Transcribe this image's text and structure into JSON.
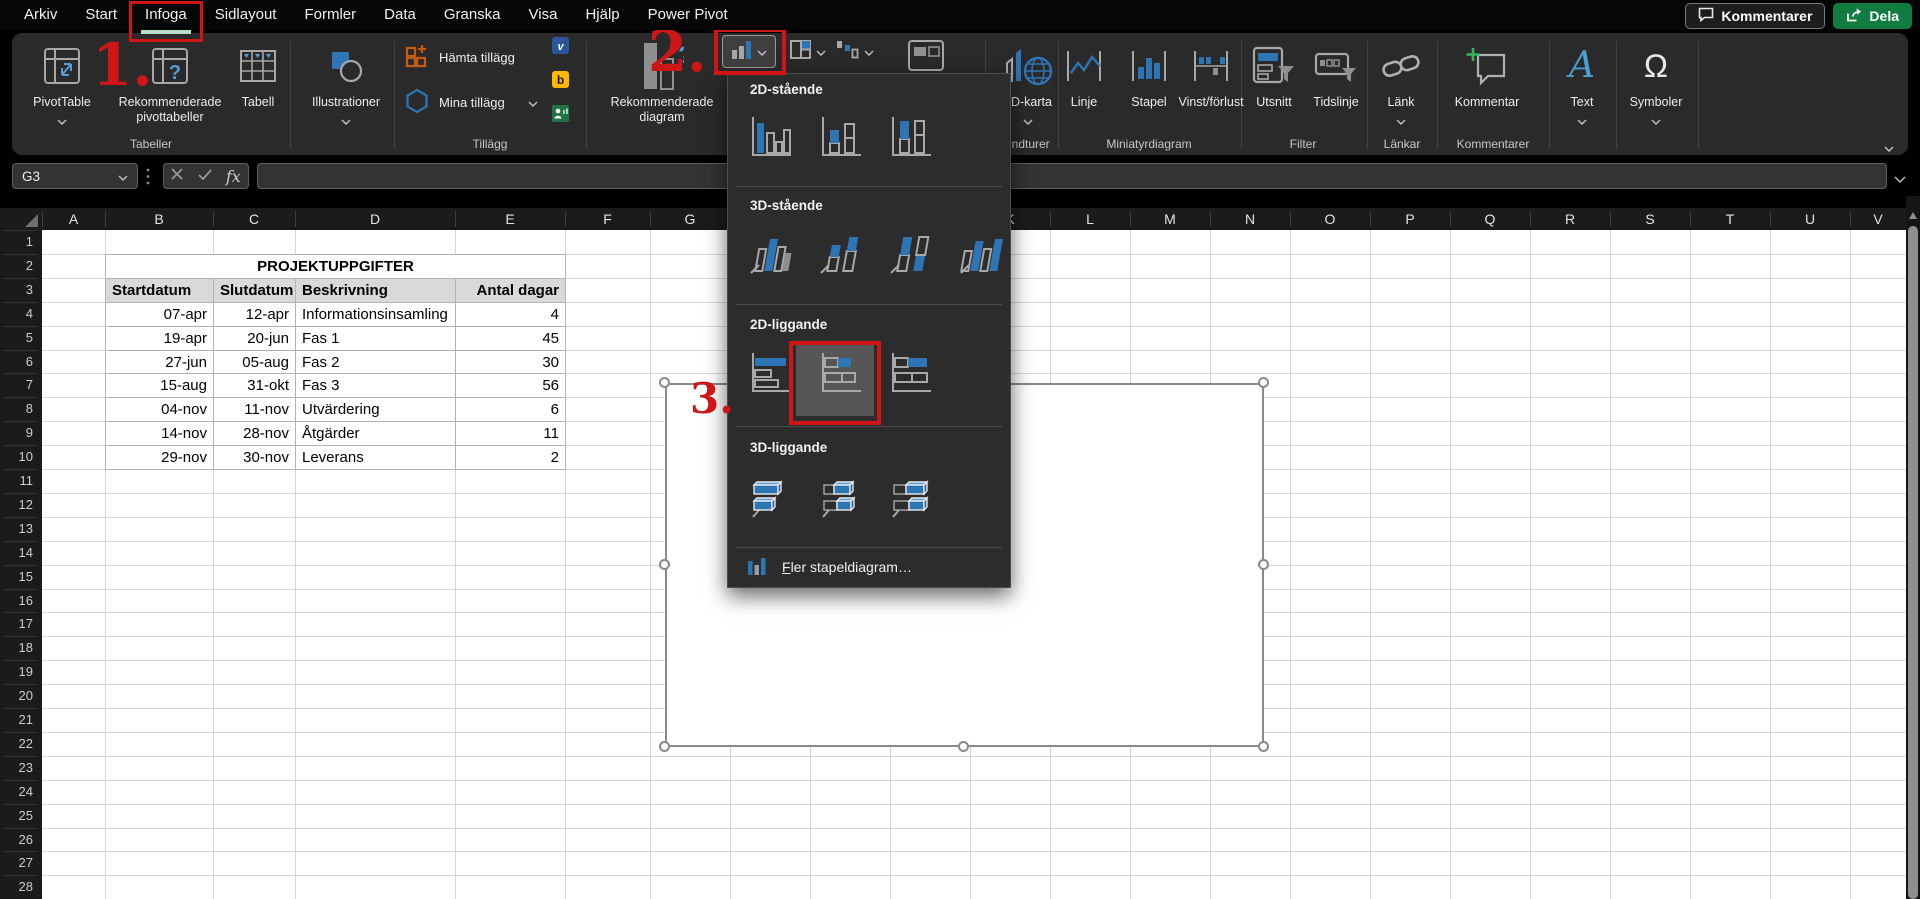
{
  "titlebar": {
    "comments_button": "Kommentarer",
    "share_button": "Dela"
  },
  "tabs": {
    "items": [
      "Arkiv",
      "Start",
      "Infoga",
      "Sidlayout",
      "Formler",
      "Data",
      "Granska",
      "Visa",
      "Hjälp",
      "Power Pivot"
    ],
    "active": "Infoga"
  },
  "ribbon": {
    "buttons": {
      "pivottable": "PivotTable",
      "recommended_pivottables": "Rekommenderade pivottabeller",
      "table": "Tabell",
      "illustrations": "Illustrationer",
      "get_addins": "Hämta tillägg",
      "my_addins": "Mina tillägg",
      "recommended_charts": "Rekommenderade diagram",
      "map3d": "3D-karta",
      "line": "Linje",
      "column": "Stapel",
      "winloss": "Vinst/förlust",
      "slicer": "Utsnitt",
      "timeline": "Tidslinje",
      "link": "Länk",
      "comment": "Kommentar",
      "text": "Text",
      "symbols": "Symboler"
    },
    "groups": [
      "Tabeller",
      "Tillägg",
      "Rundturer",
      "Miniatyrdiagram",
      "Filter",
      "Länkar",
      "Kommentarer"
    ]
  },
  "formula_bar": {
    "name_box": "G3",
    "formula_value": ""
  },
  "grid": {
    "column_headers": [
      "A",
      "B",
      "C",
      "D",
      "E",
      "F",
      "G",
      "H",
      "I",
      "J",
      "K",
      "L",
      "M",
      "N",
      "O",
      "P",
      "Q",
      "R",
      "S",
      "T",
      "U",
      "V"
    ],
    "row_count": 28
  },
  "sheet_table": {
    "title": "PROJEKTUPPGIFTER",
    "headers": [
      "Startdatum",
      "Slutdatum",
      "Beskrivning",
      "Antal dagar"
    ],
    "rows": [
      [
        "07-apr",
        "12-apr",
        "Informationsinsamling",
        "4"
      ],
      [
        "19-apr",
        "20-jun",
        "Fas 1",
        "45"
      ],
      [
        "27-jun",
        "05-aug",
        "Fas 2",
        "30"
      ],
      [
        "15-aug",
        "31-okt",
        "Fas 3",
        "56"
      ],
      [
        "04-nov",
        "11-nov",
        "Utvärdering",
        "6"
      ],
      [
        "14-nov",
        "28-nov",
        "Åtgärder",
        "11"
      ],
      [
        "29-nov",
        "30-nov",
        "Leverans",
        "2"
      ]
    ]
  },
  "chart_menu": {
    "sections": [
      {
        "label": "2D-stående",
        "icons": [
          "col-clustered",
          "col-stacked",
          "col-100"
        ]
      },
      {
        "label": "3D-stående",
        "icons": [
          "col3d-clustered",
          "col3d-stacked",
          "col3d-100",
          "col3d"
        ]
      },
      {
        "label": "2D-liggande",
        "icons": [
          "bar-clustered",
          "bar-stacked",
          "bar-100"
        ],
        "highlighted": "bar-stacked"
      },
      {
        "label": "3D-liggande",
        "icons": [
          "bar3d-clustered",
          "bar3d-stacked",
          "bar3d-100"
        ]
      }
    ],
    "more_item": "Fler stapeldiagram…"
  },
  "annotations": {
    "step1": "1.",
    "step2": "2.",
    "step3": "3."
  },
  "colors": {
    "annotation_red": "#cf1616",
    "accent_blue": "#2e75b6",
    "share_green": "#107c41",
    "active_tab_underline": "#b7dcc9",
    "table_header_fill": "#d9d9d9"
  }
}
